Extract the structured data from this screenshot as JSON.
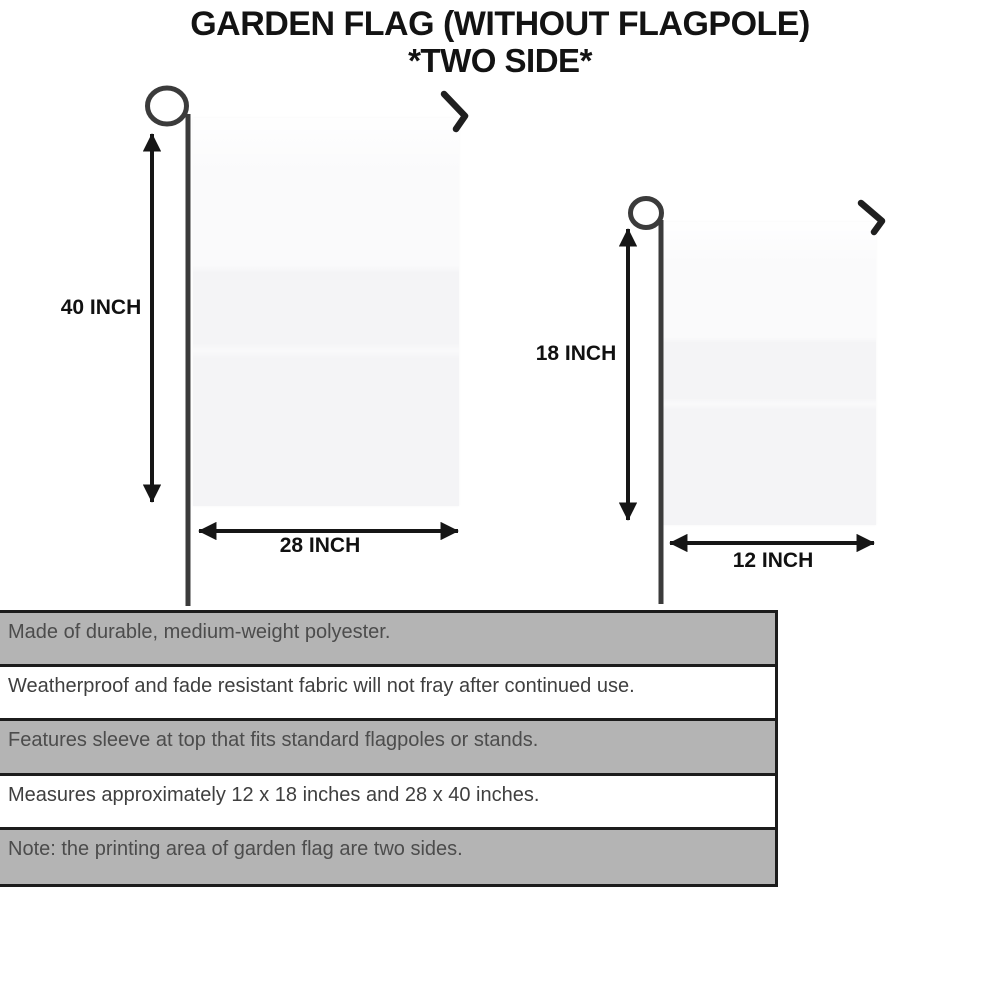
{
  "title": {
    "line1": "GARDEN FLAG (WITHOUT FLAGPOLE)",
    "line2": "*TWO SIDE*"
  },
  "diagram": {
    "large_flag": {
      "height_label": "40 INCH",
      "width_label": "28 INCH"
    },
    "small_flag": {
      "height_label": "18 INCH",
      "width_label": "12 INCH"
    }
  },
  "features": [
    "Made of durable, medium-weight polyester.",
    "Weatherproof and fade resistant fabric will not fray after continued use.",
    "Features sleeve at top that fits standard flagpoles or stands.",
    "Measures approximately 12 x 18 inches and 28 x 40 inches.",
    "Note: the printing area of garden flag are two sides."
  ],
  "colors": {
    "row_gray": "#b4b4b4",
    "row_white": "#ffffff",
    "table_border": "#1c1c1c",
    "flag_fill": "#f4f4f6",
    "pole": "#3b3b3b",
    "hook": "#1f1f1f",
    "arrow": "#161616",
    "title_text": "#131313"
  }
}
